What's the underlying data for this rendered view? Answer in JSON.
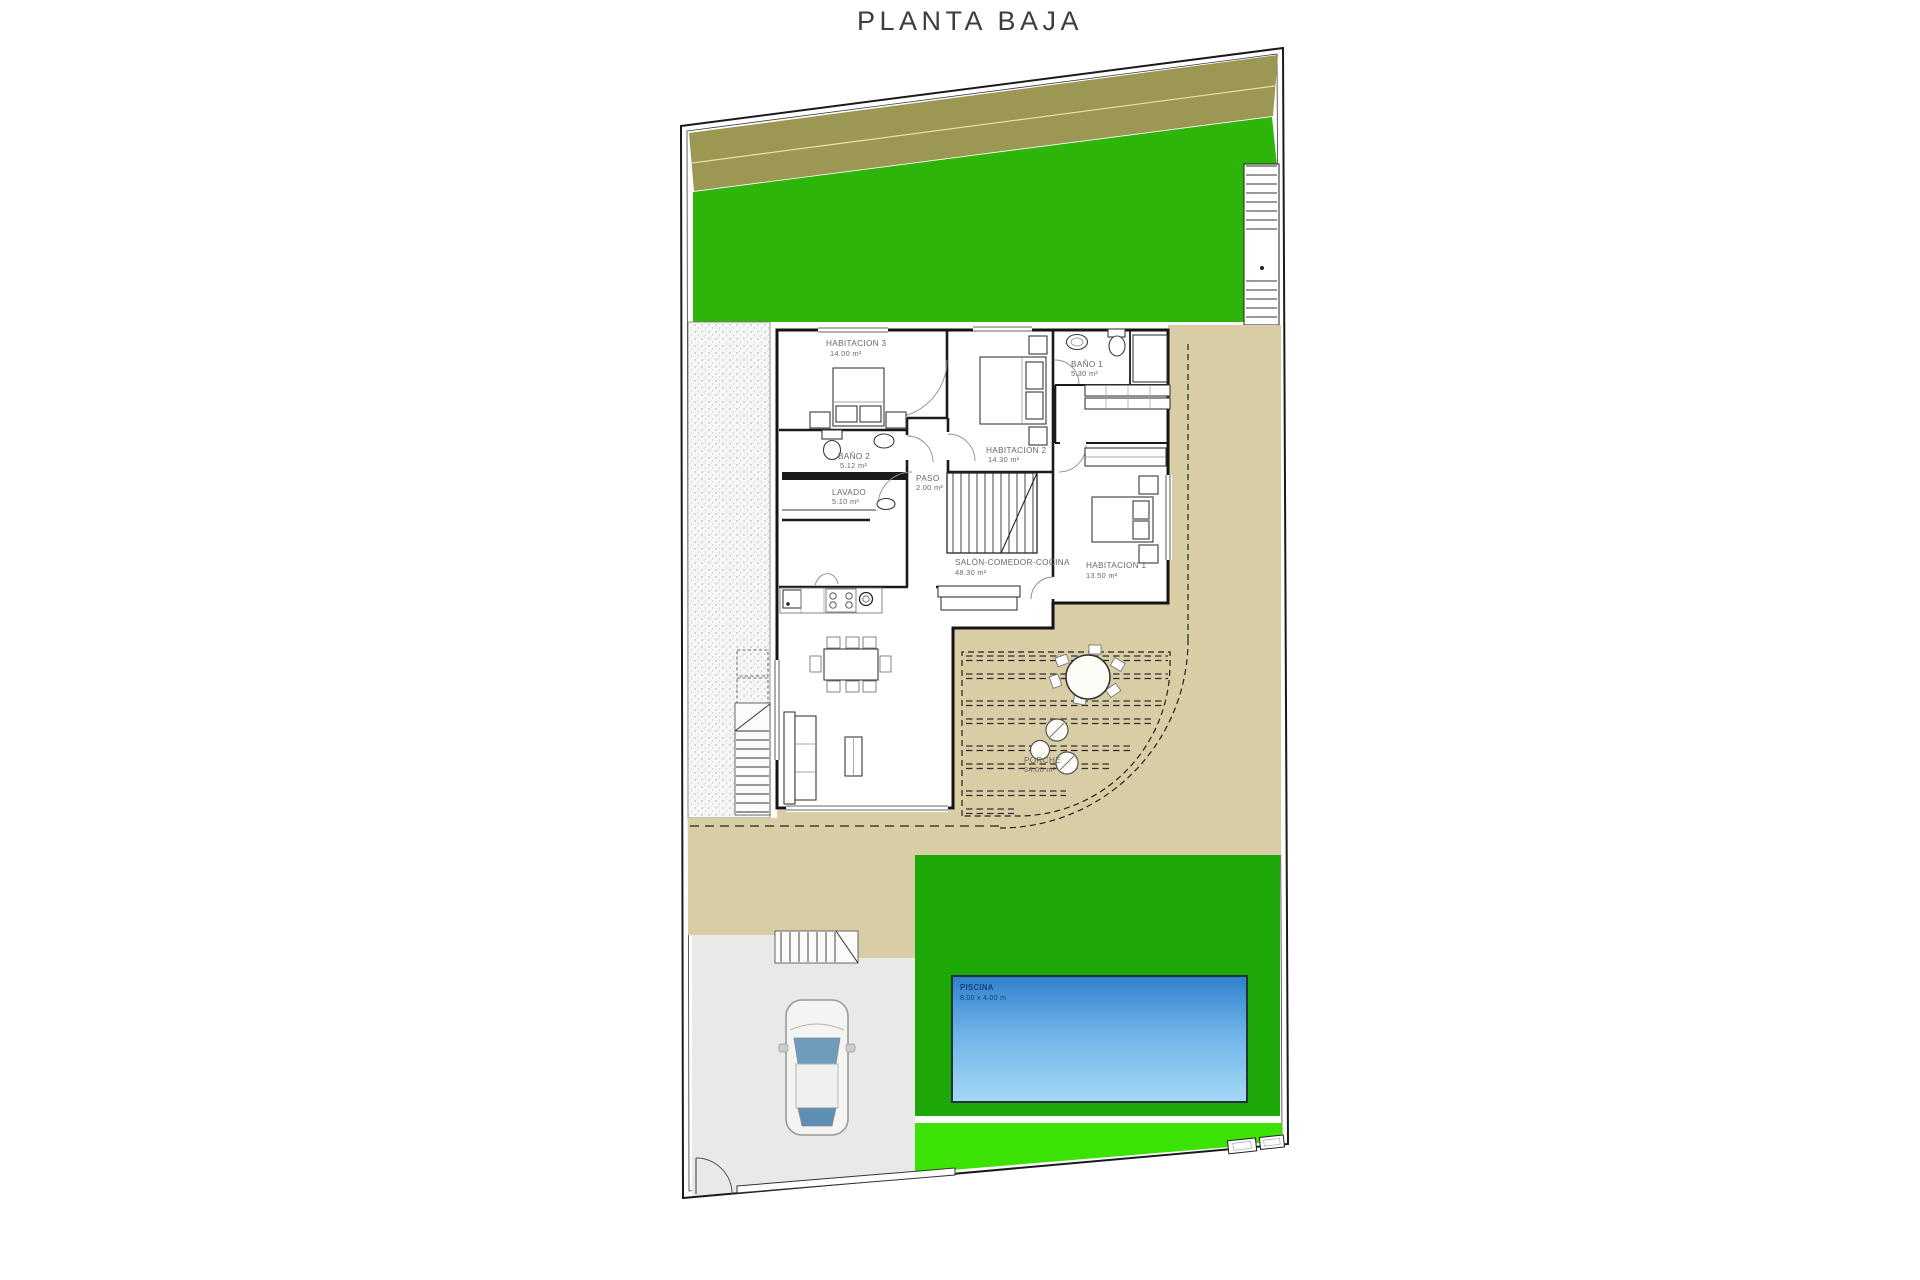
{
  "title": "PLANTA BAJA",
  "rooms": {
    "habitacion3": {
      "name": "HABITACION 3",
      "area": "14.00 m²"
    },
    "bano2": {
      "name": "BAÑO 2",
      "area": "5.12 m²"
    },
    "lavado": {
      "name": "LAVADO",
      "area": "5.10 m²"
    },
    "paso": {
      "name": "PASO",
      "area": "2.00 m²"
    },
    "habitacion2": {
      "name": "HABITACION 2",
      "area": "14.30 m²"
    },
    "bano1": {
      "name": "BAÑO 1",
      "area": "5.30 m²"
    },
    "salon": {
      "name": "SALÓN-COMEDOR-COCINA",
      "area": "48.30 m²"
    },
    "habitacion1": {
      "name": "HABITACION 1",
      "area": "13.50 m²"
    },
    "porche": {
      "name": "PORCHE",
      "area": "34.00 m²"
    },
    "piscina": {
      "name": "PISCINA",
      "area": "8.00 x 4.00 m"
    }
  },
  "colors": {
    "lawn": "#2db50a",
    "pool-surround": "#1ea808",
    "lawn-bright": "#3ce205",
    "olive": "#9c9853",
    "terrace": "#d9cda5",
    "garage": "#e9e9e8",
    "pool-top": "#2f80cc",
    "pool-bottom": "#a4d8f6",
    "wall": "#1a1a1a",
    "label": "#6a675e",
    "pool-label": "#16427c"
  }
}
